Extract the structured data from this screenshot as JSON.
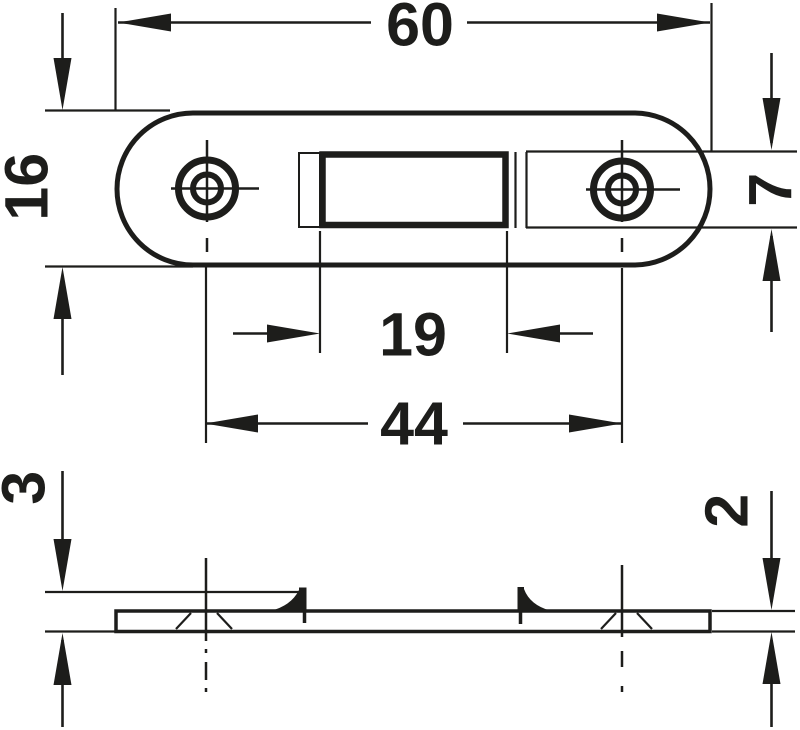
{
  "drawing": {
    "type": "technical-dimension-drawing",
    "ink": "#1d1d1b",
    "background": "#ffffff"
  },
  "dimensions": {
    "plate_width": "60",
    "plate_height": "16",
    "recess_height": "7",
    "slot_width": "19",
    "hole_spacing": "44",
    "overall_height_with_tabs": "3",
    "plate_thickness": "2"
  }
}
